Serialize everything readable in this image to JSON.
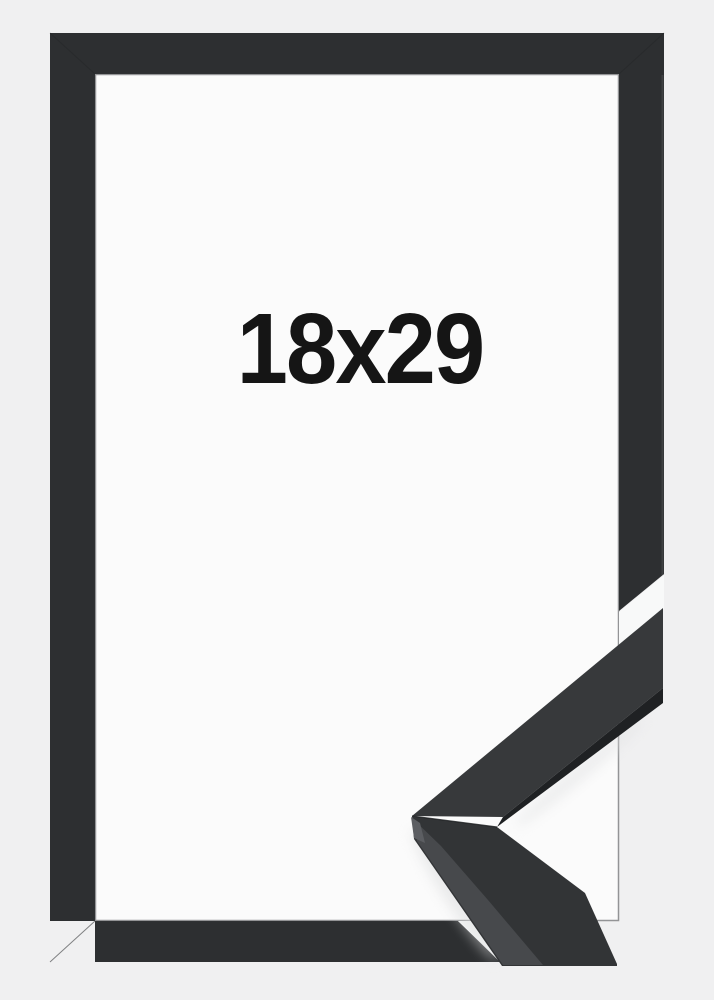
{
  "photo": {
    "size_label": "18x29",
    "colors": {
      "background": "#f0f0f1",
      "opening": "#fbfbfb",
      "frame": "#2d2f31",
      "gap": "#f8f9f9",
      "sample_top_face": "#37393b",
      "sample_inner_edge": "#1f2123",
      "sample_bottom_face": "#323436",
      "sample_outer_face": "#47494c",
      "sample_end_face": "#5c5e62",
      "label_text": "#151515"
    }
  }
}
